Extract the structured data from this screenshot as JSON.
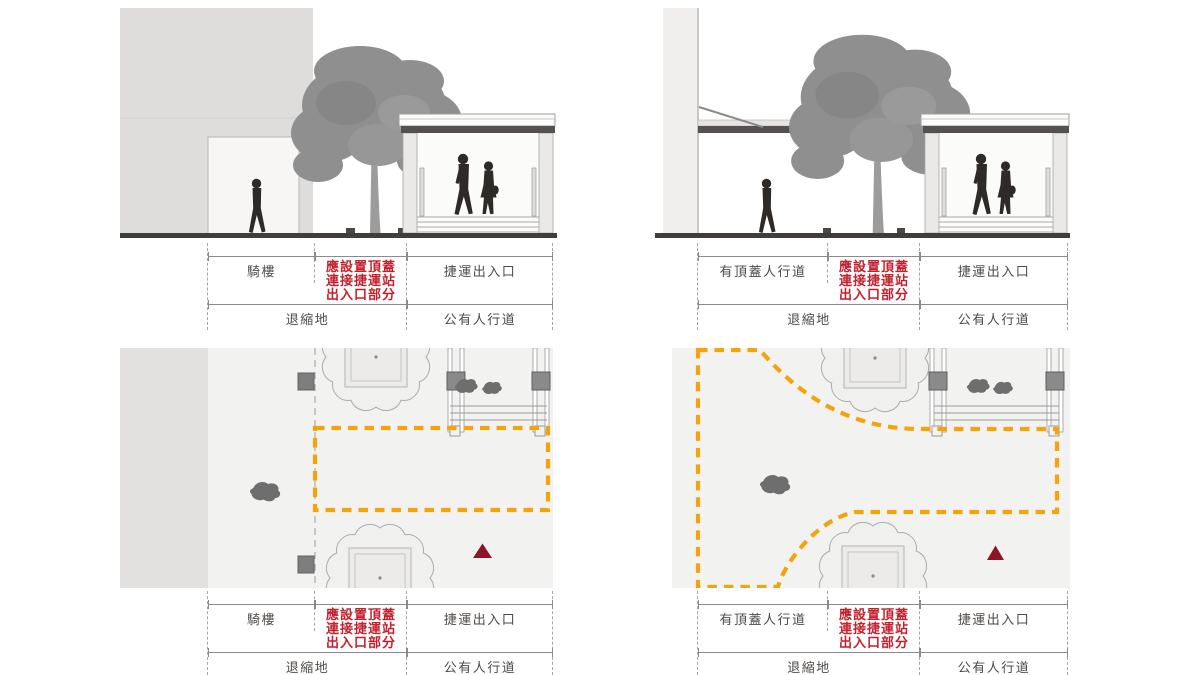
{
  "colors": {
    "required_canopy_text": "#C2202C",
    "required_canopy_outline": "#F3A40A",
    "entrance_marker_triangle": "#8D1626",
    "silhouette": "#2D2A28",
    "building_fill": "#DEDDDC",
    "plan_background": "#F2F2F1",
    "ground_line": "#403D3B",
    "dimension_line": "#8B8B8B"
  },
  "panels": [
    {
      "id": "top-left",
      "view": "elevation-arcade",
      "dim_row1": [
        {
          "label": "騎樓",
          "highlight": false
        },
        {
          "lines": [
            "應設置頂蓋",
            "連接捷運站",
            "出入口部分"
          ],
          "highlight": true
        },
        {
          "label": "捷運出入口",
          "highlight": false
        }
      ],
      "dim_row2": [
        {
          "label": "退縮地"
        },
        {
          "label": "公有人行道"
        }
      ]
    },
    {
      "id": "top-right",
      "view": "elevation-covered-walkway",
      "dim_row1": [
        {
          "label": "有頂蓋人行道",
          "highlight": false
        },
        {
          "lines": [
            "應設置頂蓋",
            "連接捷運站",
            "出入口部分"
          ],
          "highlight": true
        },
        {
          "label": "捷運出入口",
          "highlight": false
        }
      ],
      "dim_row2": [
        {
          "label": "退縮地"
        },
        {
          "label": "公有人行道"
        }
      ]
    },
    {
      "id": "bottom-left",
      "view": "plan-arcade",
      "dim_row1": [
        {
          "label": "騎樓",
          "highlight": false
        },
        {
          "lines": [
            "應設置頂蓋",
            "連接捷運站",
            "出入口部分"
          ],
          "highlight": true
        },
        {
          "label": "捷運出入口",
          "highlight": false
        }
      ],
      "dim_row2": [
        {
          "label": "退縮地"
        },
        {
          "label": "公有人行道"
        }
      ]
    },
    {
      "id": "bottom-right",
      "view": "plan-covered-walkway",
      "dim_row1": [
        {
          "label": "有頂蓋人行道",
          "highlight": false
        },
        {
          "lines": [
            "應設置頂蓋",
            "連接捷運站",
            "出入口部分"
          ],
          "highlight": true
        },
        {
          "label": "捷運出入口",
          "highlight": false
        }
      ],
      "dim_row2": [
        {
          "label": "退縮地"
        },
        {
          "label": "公有人行道"
        }
      ]
    }
  ]
}
